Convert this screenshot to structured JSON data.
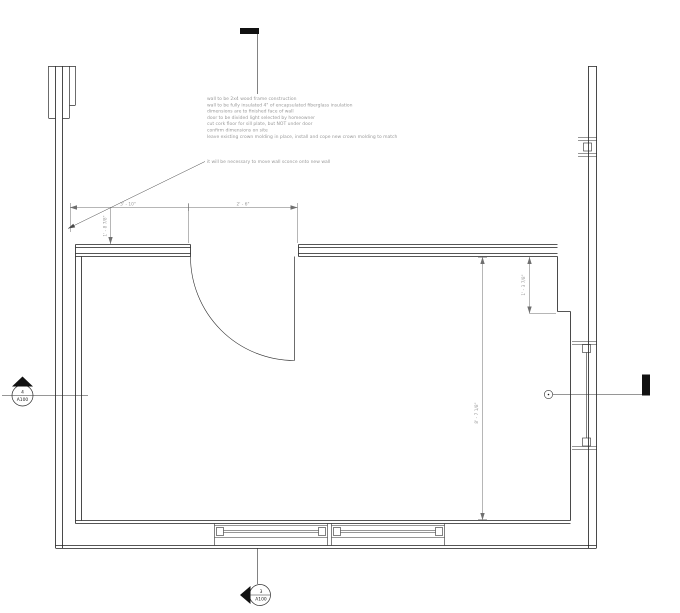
{
  "drawing": {
    "notes": {
      "general": [
        "wall to be 2x4 wood frame construction",
        "wall to be fully insulated 4\" of encapsulated fiberglass insulation",
        "dimensions are to finished face of wall",
        "door to be divided light selected by homeowner",
        "cut cork floor for sill plate, but NOT under door",
        "confirm dimensions on site",
        "leave existing crown molding in place, install and cope new crown molding to match"
      ],
      "sconce_note": "it will be necessary to move wall sconce onto new wall"
    },
    "dimensions": {
      "top_left": "3' - 10\"",
      "top_right": "2' - 6\"",
      "left_vertical": "1' - 8 7/8\"",
      "right_upper": "1' - 3 7/8\"",
      "right_long": "8' - 7 1/8\""
    },
    "section_markers": {
      "left": {
        "detail": "4",
        "sheet": "A100"
      },
      "bottom": {
        "detail": "3",
        "sheet": "A100"
      }
    },
    "colors": {
      "wall_line": "#1f1f1f",
      "dim_line": "#6f6f6f",
      "note_text": "#9a9a9a"
    }
  }
}
